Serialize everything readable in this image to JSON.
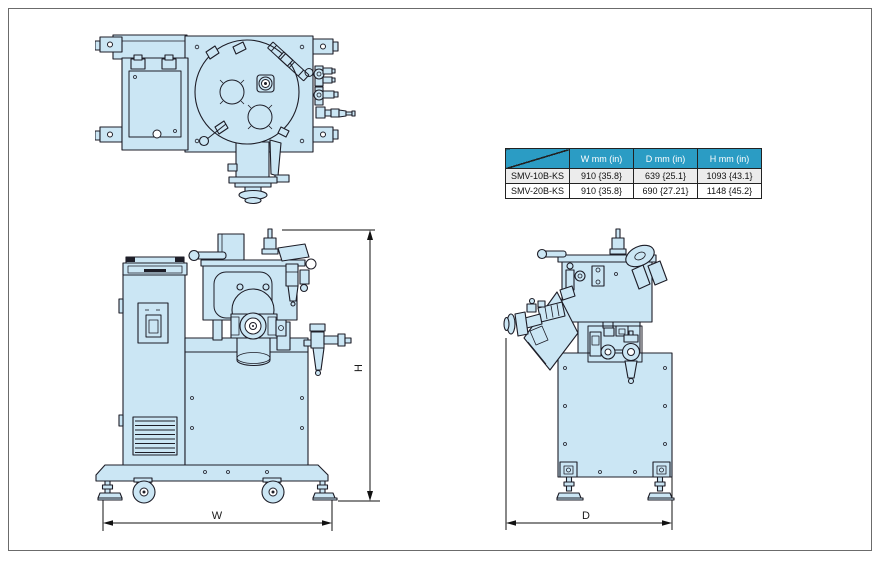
{
  "spec_table": {
    "columns": [
      "W mm (in)",
      "D mm (in)",
      "H mm (in)"
    ],
    "rows": [
      {
        "model": "SMV-10B-KS",
        "w": "910 {35.8}",
        "d": "639 {25.1}",
        "h": "1093 {43.1}"
      },
      {
        "model": "SMV-20B-KS",
        "w": "910 {35.8}",
        "d": "690 {27.21}",
        "h": "1148 {45.2}"
      }
    ]
  },
  "dimensions": {
    "width_label": "W",
    "height_label": "H",
    "depth_label": "D"
  },
  "colors": {
    "machine_fill": "#cbe6f4",
    "machine_line": "#1d1d27",
    "table_header_bg": "#2b9cc4",
    "table_header_text": "#ffffff",
    "table_alt_row_bg": "#ececec",
    "page_border": "#6b6b6b"
  }
}
